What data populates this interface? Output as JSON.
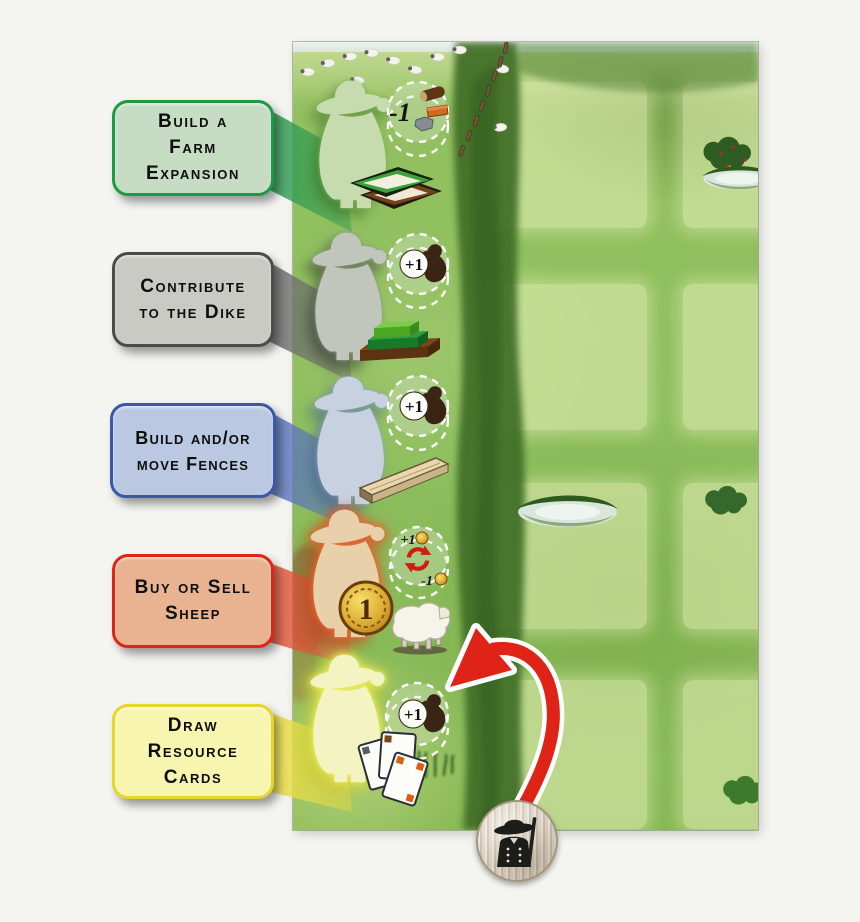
{
  "callouts": [
    {
      "id": "build-farm-expansion",
      "label": "Build a Farm Expansion",
      "lines": [
        "Build a",
        "Farm",
        "Expansion"
      ],
      "box_fill": "#c6dcc3",
      "box_border": "#1f9a44",
      "wedge_color": "#2f9b52",
      "token_value": "-1",
      "token_icons": [
        "wood-log-icon",
        "brick-icon",
        "stone-icon"
      ],
      "item_icon": "farm-expansion-tiles-icon",
      "meeple_color": "#c6dcae"
    },
    {
      "id": "contribute-to-the-dike",
      "label": "Contribute to the Dike",
      "lines": [
        "Contribute",
        "to the Dike"
      ],
      "box_fill": "#c9cac4",
      "box_border": "#4b4b4b",
      "wedge_color": "#6e6e6e",
      "token_value": "+1",
      "token_icons": [
        "bird-icon"
      ],
      "item_icon": "dike-pieces-icon",
      "meeple_color": "#c0c6bb"
    },
    {
      "id": "build-move-fences",
      "label": "Build and/or move Fences",
      "lines": [
        "Build and/or",
        "move Fences"
      ],
      "box_fill": "#bac9e1",
      "box_border": "#3a57a9",
      "wedge_color": "#5b76bd",
      "token_value": "+1",
      "token_icons": [
        "bird-icon"
      ],
      "item_icon": "fence-beam-icon",
      "meeple_color": "#c7d1e0"
    },
    {
      "id": "buy-or-sell-sheep",
      "label": "Buy or Sell Sheep",
      "lines": [
        "Buy or Sell",
        "Sheep"
      ],
      "box_fill": "#e9b290",
      "box_border": "#df2517",
      "wedge_color": "#e2543a",
      "token_value_top": "+1",
      "token_value_bottom": "-1",
      "token_icons": [
        "coin-icon",
        "swap-arrows-icon",
        "coin-icon"
      ],
      "item_icon": "coin-and-sheep-icon",
      "meeple_color": "#e8d0ab"
    },
    {
      "id": "draw-resource-cards",
      "label": "Draw Resource Cards",
      "lines": [
        "Draw",
        "Resource",
        "Cards"
      ],
      "box_fill": "#f8f5b1",
      "box_border": "#e5d627",
      "wedge_color": "#e9dd46",
      "token_value": "+1",
      "token_icons": [
        "bird-icon"
      ],
      "item_icon": "resource-cards-icon",
      "meeple_color": "#f4f4c3"
    }
  ],
  "coin": {
    "value": "1"
  },
  "board": {
    "bg_green": "#8cbd5c",
    "hedge_green": "#3f6e28",
    "square_fill": "#e9f3ba",
    "decoration_icons": [
      "sheep-icon",
      "fence-post-icon",
      "pond-icon",
      "bush-icon",
      "grass-tuft-icon"
    ]
  },
  "bottom_token": {
    "icon": "farmer-pawn-icon"
  },
  "arrow": {
    "icon": "curved-red-arrow-icon",
    "color": "#df2417"
  }
}
